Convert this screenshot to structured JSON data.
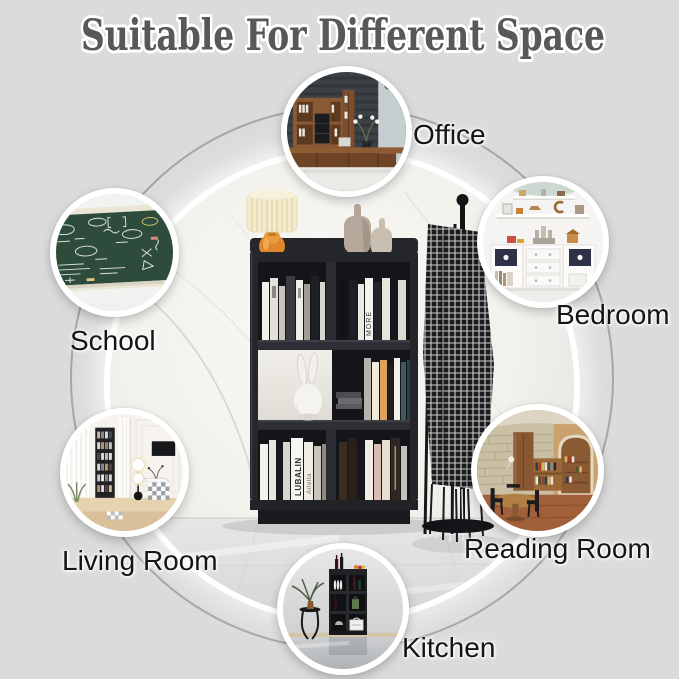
{
  "title": "Suitable For Different Space",
  "spaces": [
    {
      "id": "office",
      "label": "Office"
    },
    {
      "id": "bedroom",
      "label": "Bedroom"
    },
    {
      "id": "school",
      "label": "School"
    },
    {
      "id": "living-room",
      "label": "Living Room"
    },
    {
      "id": "reading-room",
      "label": "Reading Room"
    },
    {
      "id": "kitchen",
      "label": "Kitchen"
    }
  ],
  "center_photo": {
    "subject": "black 3-tier 5-cube bookcase with books and decor",
    "book_titles": [
      "LUBALIN",
      "Arletta",
      "MORE"
    ]
  },
  "colors": {
    "background": "#dbdbdb",
    "title_text": "#585858",
    "title_outline": "#ffffff",
    "label_text": "#141414",
    "connector_ring": "#9b9b9b",
    "circle_border": "#ffffff",
    "bookcase_black": "#25262a",
    "lamp_orange": "#e1862b",
    "chalkboard_green": "#2e4c3b"
  }
}
